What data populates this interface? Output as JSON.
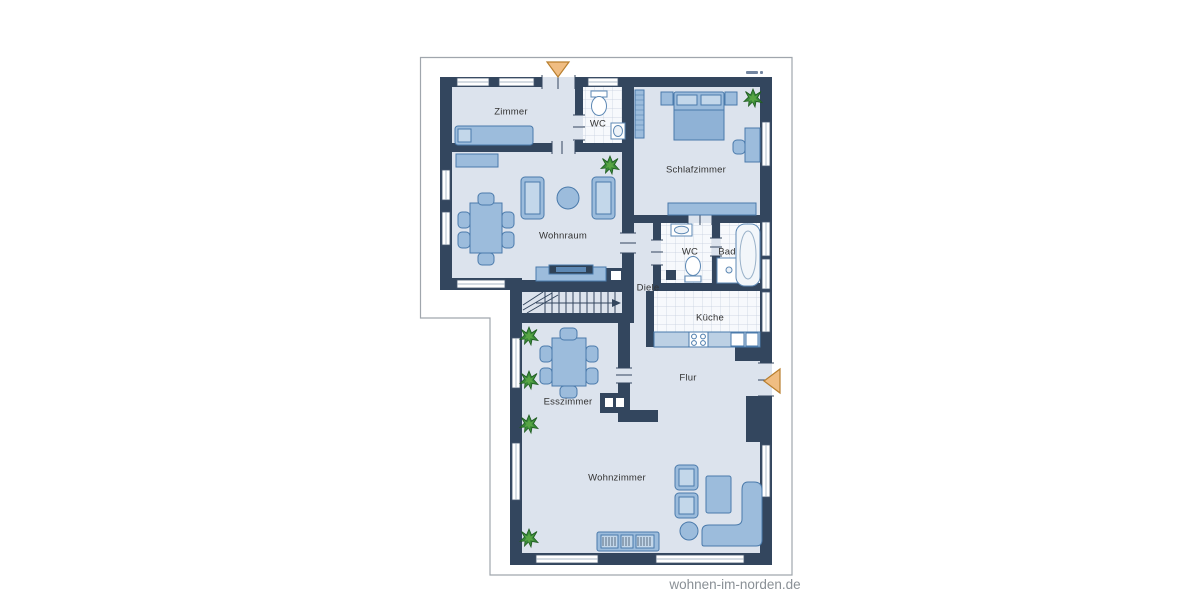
{
  "watermark": {
    "text": "wohnen-im-norden.de"
  },
  "plan": {
    "type": "floorplan",
    "rooms": [
      {
        "id": "zimmer",
        "label": "Zimmer"
      },
      {
        "id": "wc-upper",
        "label": "WC"
      },
      {
        "id": "schlafzimmer",
        "label": "Schlafzimmer"
      },
      {
        "id": "wohnraum",
        "label": "Wohnraum"
      },
      {
        "id": "diele",
        "label": "Diele"
      },
      {
        "id": "wc-middle",
        "label": "WC"
      },
      {
        "id": "bad",
        "label": "Bad"
      },
      {
        "id": "kueche",
        "label": "Küche"
      },
      {
        "id": "flur",
        "label": "Flur"
      },
      {
        "id": "esszimmer",
        "label": "Esszimmer"
      },
      {
        "id": "wohnzimmer",
        "label": "Wohnzimmer"
      }
    ],
    "colors": {
      "wall": "#33465e",
      "floor": "#dce3ed",
      "tile": "#f7f9fc",
      "furniture": "#9cbcdc",
      "furniture_border": "#4a7aab",
      "furniture_light": "#c3d7ea",
      "plant": "#3a8a3a",
      "entrance_arrow": "#f0bd82",
      "entrance_arrow_border": "#b97f2e",
      "outline": "#a0a6ad",
      "label": "#333333",
      "watermark": "#8a9096"
    }
  }
}
